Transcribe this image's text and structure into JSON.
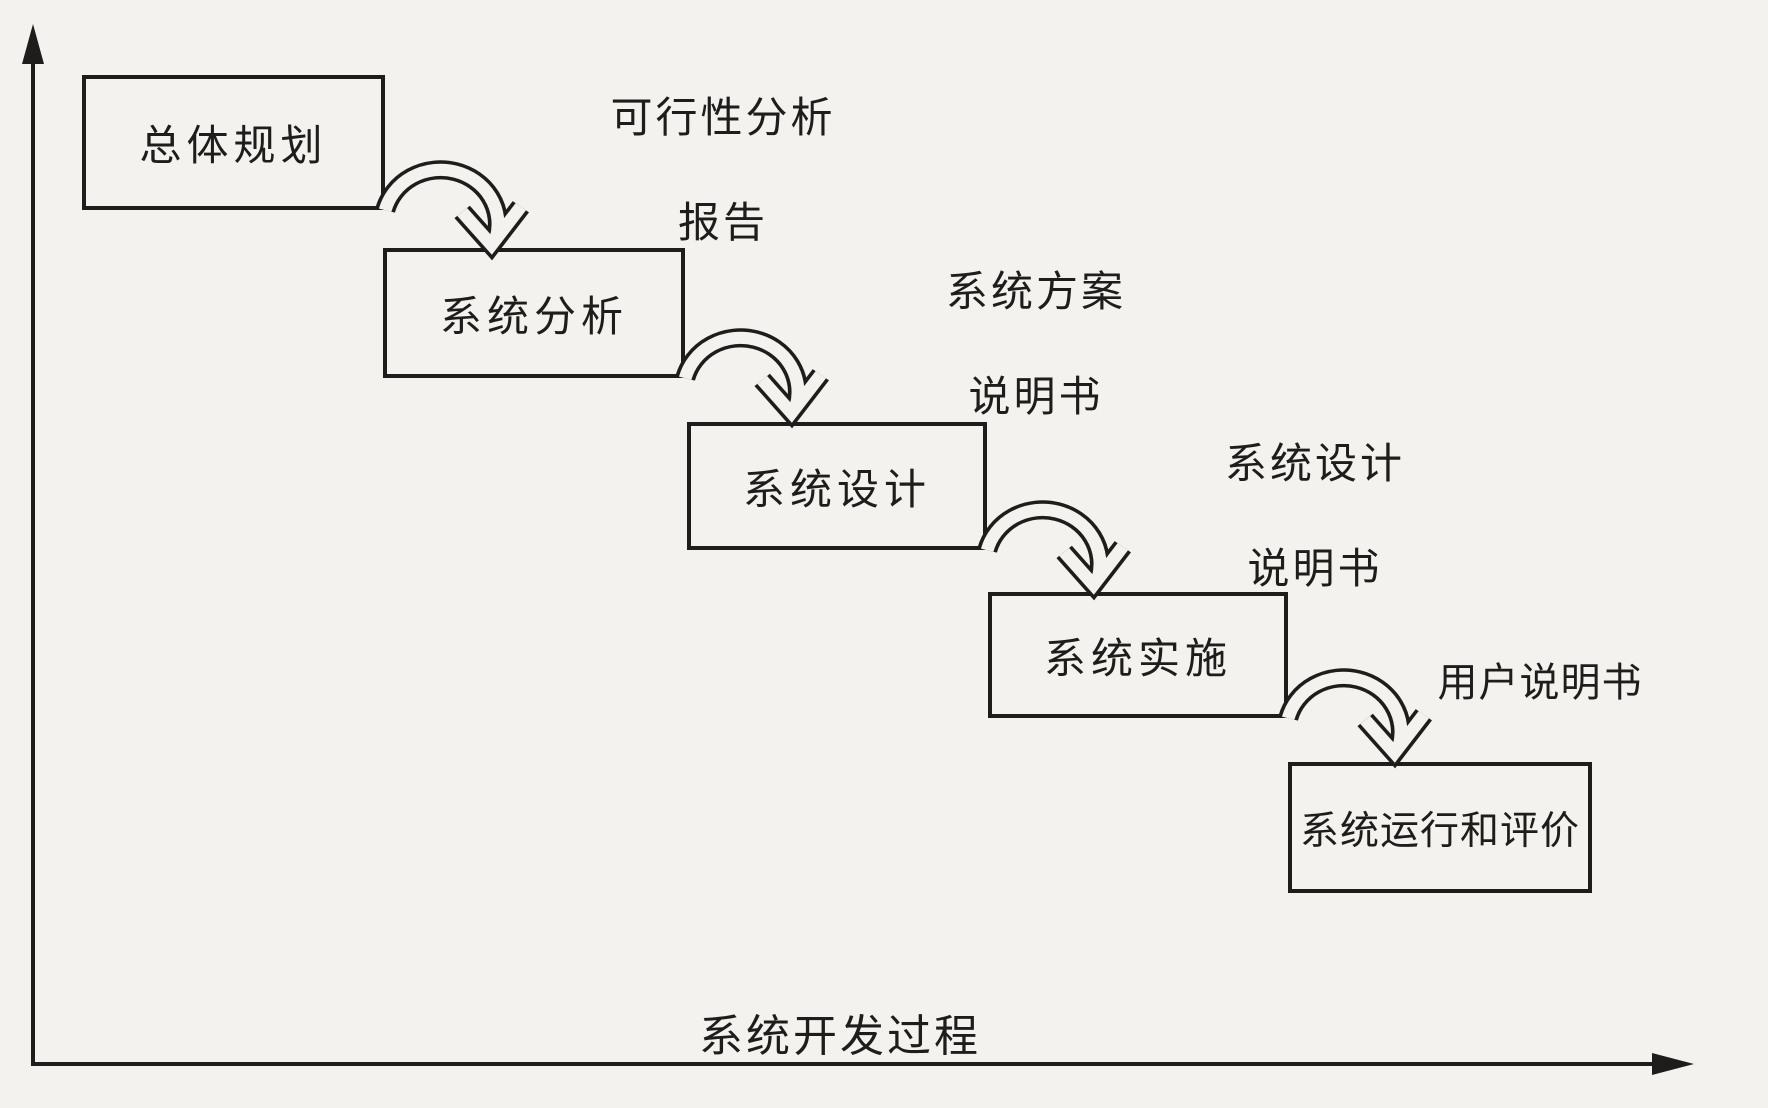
{
  "diagram": {
    "stages": [
      {
        "label": "总体规划"
      },
      {
        "label": "系统分析"
      },
      {
        "label": "系统设计"
      },
      {
        "label": "系统实施"
      },
      {
        "label": "系统运行和评价"
      }
    ],
    "deliverables": [
      {
        "line1": "可行性分析",
        "line2": "报告"
      },
      {
        "line1": "系统方案",
        "line2": "说明书"
      },
      {
        "line1": "系统设计",
        "line2": "说明书"
      },
      {
        "line1": "用户说明书"
      }
    ],
    "x_axis": {
      "label": "系统开发过程"
    },
    "icons": {
      "flow_arrow": "curved-arc-arrow-down-right",
      "y_axis_arrow": "up-arrowhead",
      "x_axis_arrow": "right-arrowhead"
    },
    "colors": {
      "ink": "#1f1d1b",
      "paper": "#f3f2ee"
    }
  }
}
